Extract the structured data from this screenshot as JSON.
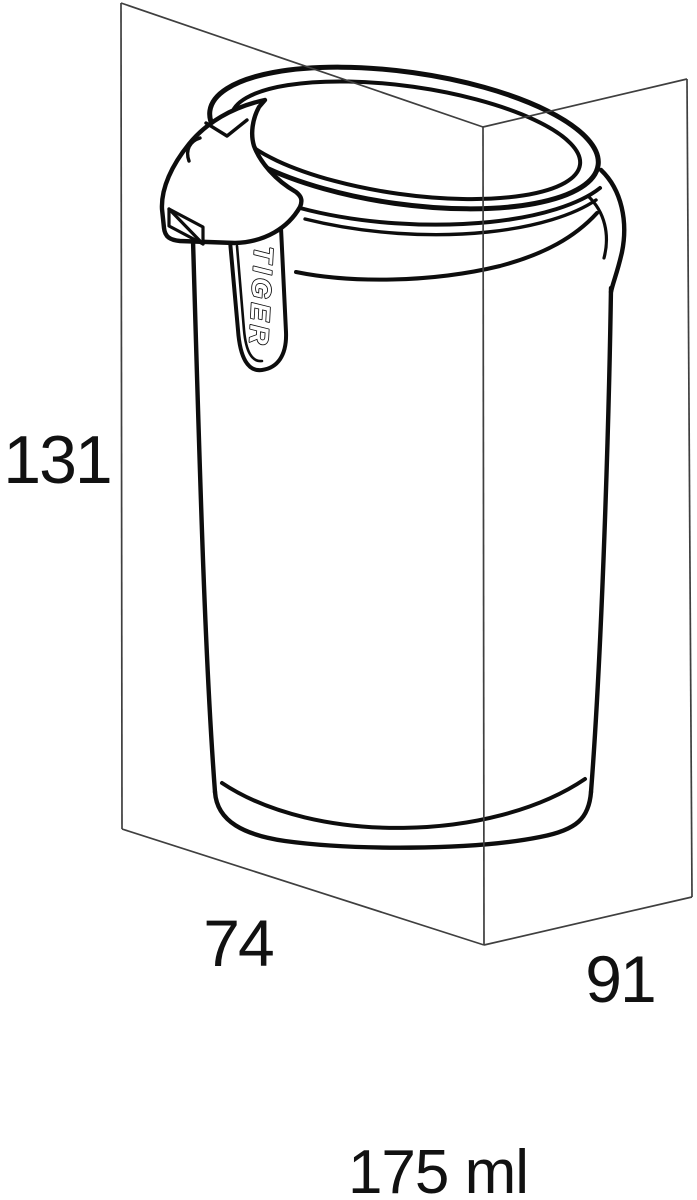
{
  "diagram": {
    "title": "soap dispenser dimension drawing",
    "brand": "TIGER",
    "dimensions": {
      "height": "131",
      "width": "74",
      "depth": "91",
      "volume": "175 ml"
    },
    "colors": {
      "background": "#ffffff",
      "object_outline": "#0d0d0d",
      "bounding_box_line": "#3f3f3f",
      "label_text": "#111111"
    }
  }
}
